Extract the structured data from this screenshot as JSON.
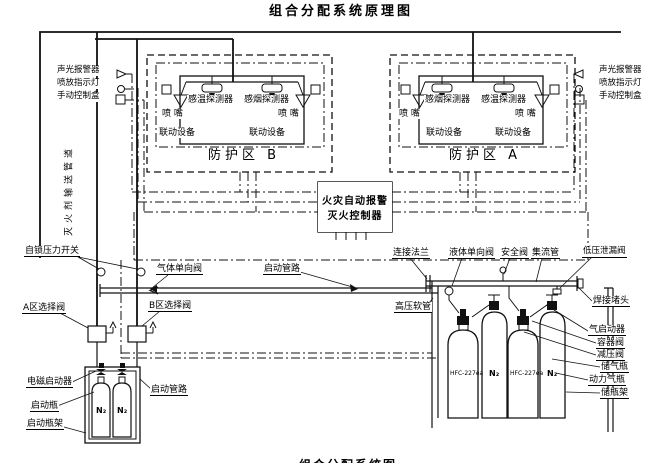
{
  "title": "组合分配系统原理图",
  "caption_partial": "组合分配系统图",
  "alarm_panel": {
    "sound_light_alarm": "声光报警器",
    "discharge_indicator_light": "喷放指示灯",
    "manual_control_box": "手动控制盒"
  },
  "supply_pipe_label": "灭火剂输送管道",
  "common": {
    "heat_detector": "感温探测器",
    "smoke_detector": "感烟探测器",
    "nozzle": "喷  嘴",
    "linkage_device": "联动设备"
  },
  "zone_b": {
    "title": "防护区 B"
  },
  "zone_a": {
    "title": "防护区 A"
  },
  "controller": {
    "line1": "火灾自动报警",
    "line2": "灭火控制器"
  },
  "left_equipment": {
    "self_locking_pressure_switch": "自锁压力开关",
    "gas_check_valve": "气体单向阀",
    "start_pipeline": "启动管路",
    "zone_a_selector_valve": "A区选择阀",
    "zone_b_selector_valve": "B区选择阀",
    "solenoid_actuator": "电磁启动器",
    "pilot_cylinder": "启动瓶",
    "pilot_cylinder_rack": "启动瓶架"
  },
  "right_equipment": {
    "connecting_flange": "连接法兰",
    "liquid_check_valve": "液体单向阀",
    "safety_valve": "安全阀",
    "manifold": "集流管",
    "low_pressure_leak_valve": "低压泄漏阀",
    "welded_plug": "焊接堵头",
    "high_pressure_hose": "高压软管",
    "gas_actuator": "气启动器",
    "container_valve": "容器阀",
    "pressure_reducing_valve": "减压阀",
    "storage_cylinder": "储气瓶",
    "power_cylinder": "动力气瓶",
    "cylinder_rack": "储瓶架"
  },
  "cylinders": {
    "agent": "HFC-227ea",
    "nitrogen": "N₂"
  }
}
